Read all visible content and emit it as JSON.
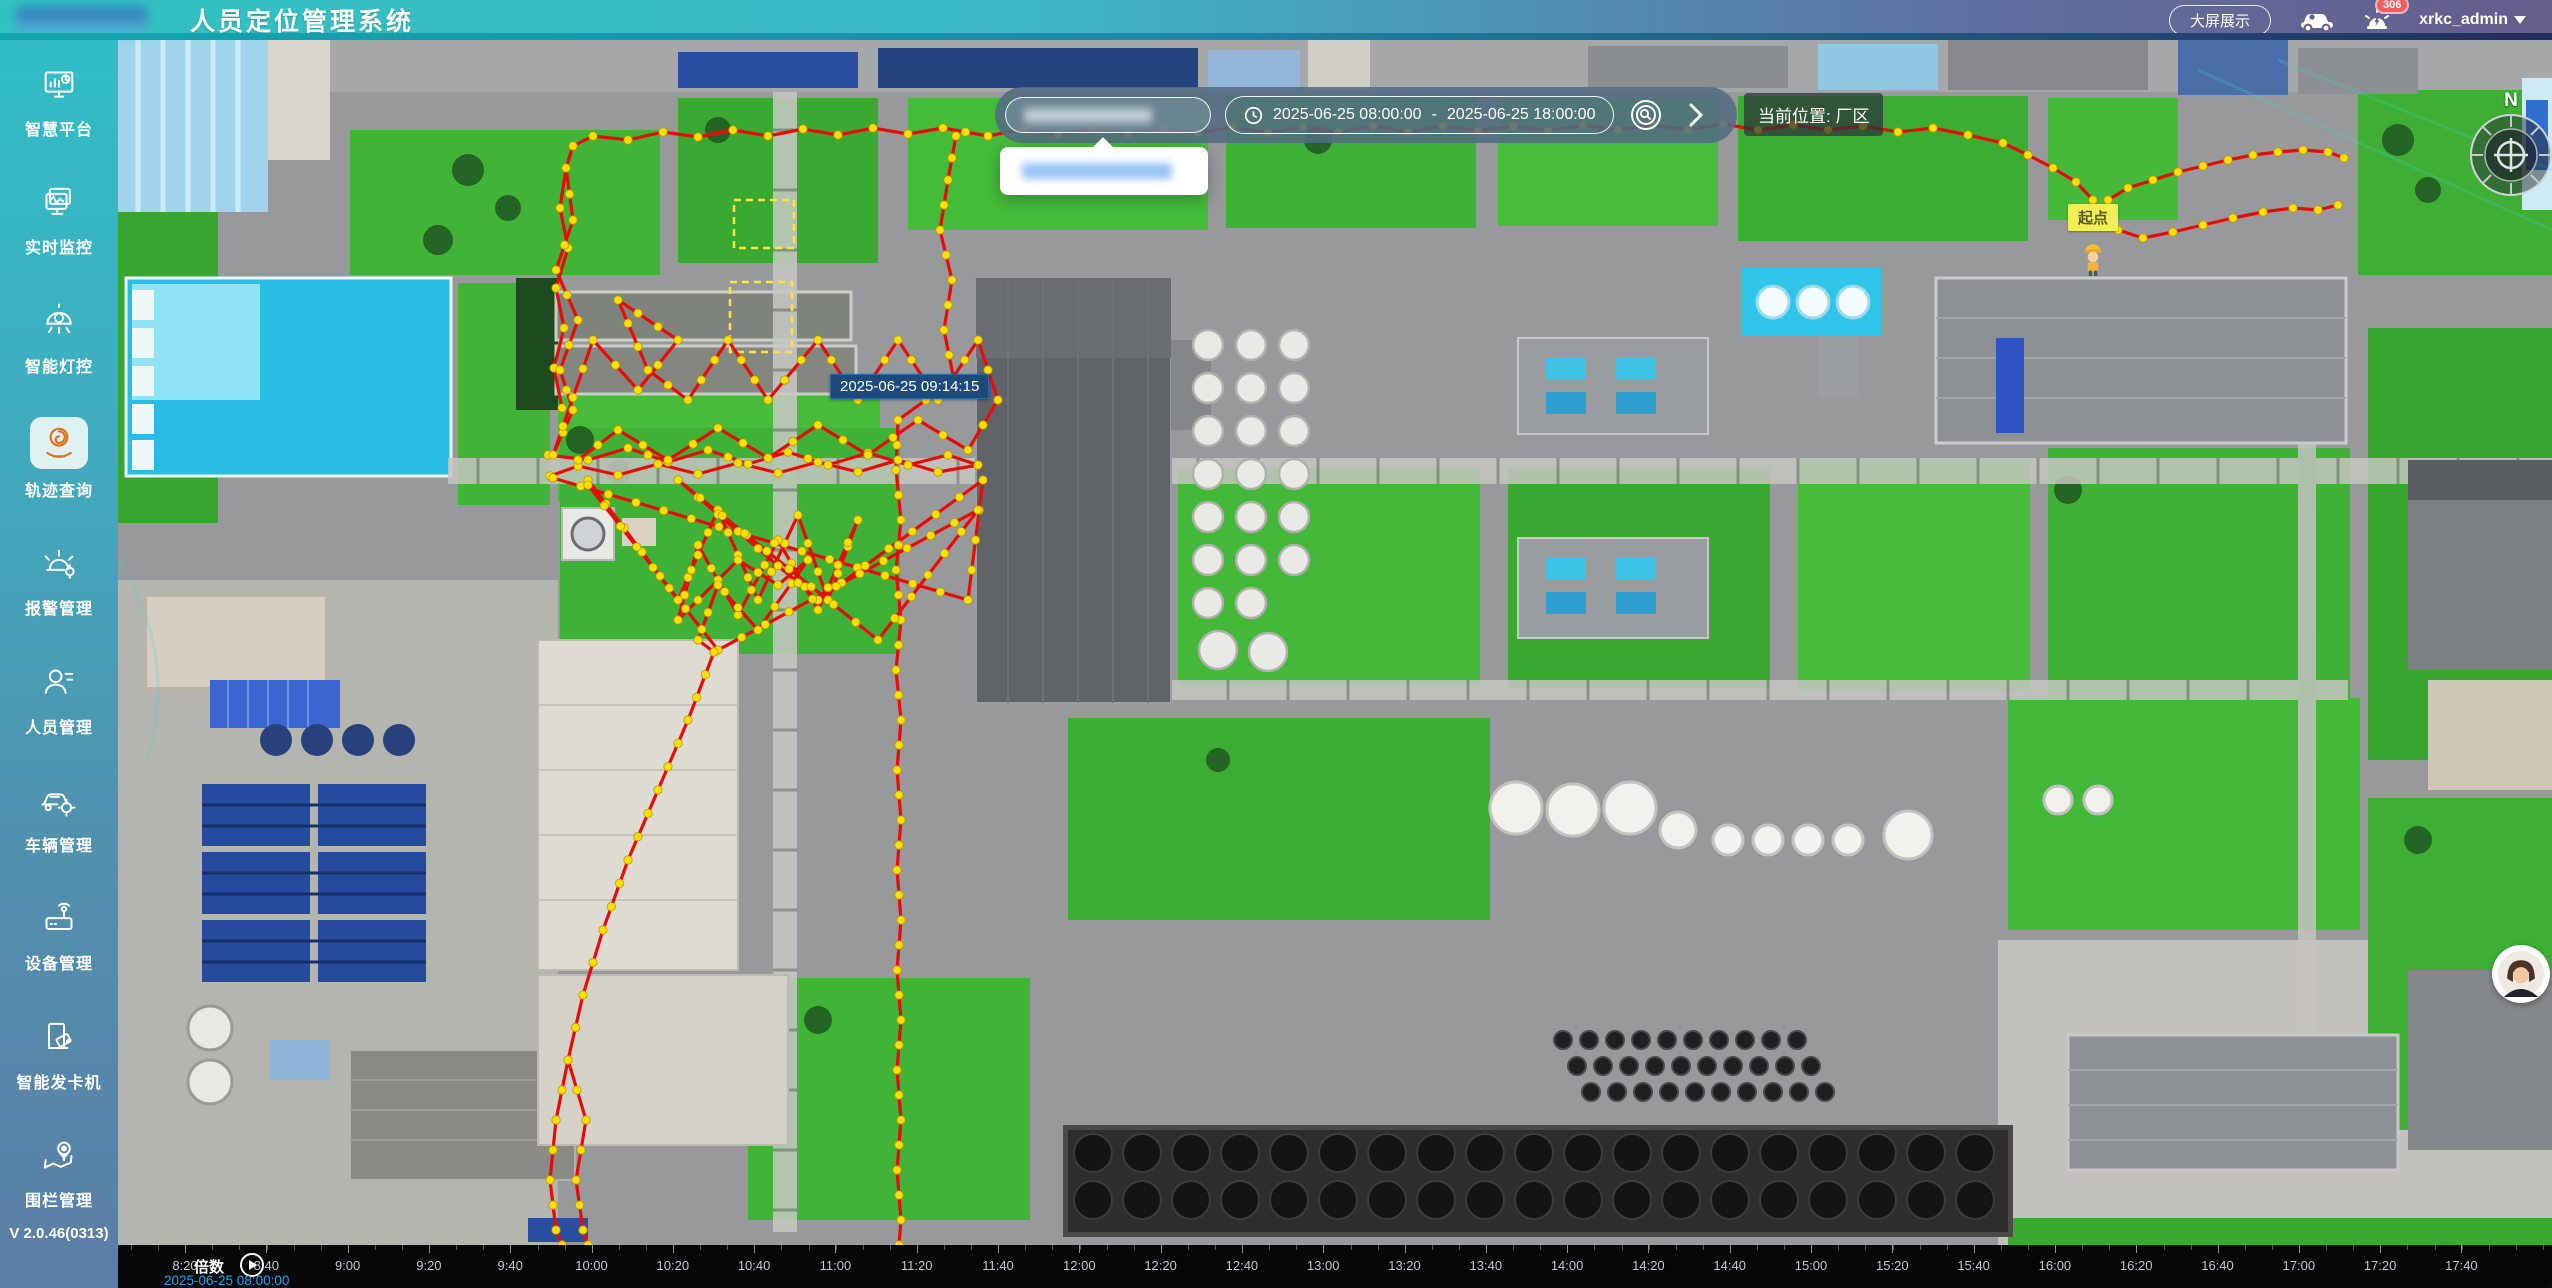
{
  "header": {
    "title": "人员定位管理系统",
    "big_screen_button": "大屏展示",
    "alarm_badge": "306",
    "username": "xrkc_admin"
  },
  "sidebar": {
    "items": [
      {
        "label": "智慧平台",
        "active": false
      },
      {
        "label": "实时监控",
        "active": false
      },
      {
        "label": "智能灯控",
        "active": false
      },
      {
        "label": "轨迹查询",
        "active": true
      },
      {
        "label": "报警管理",
        "active": false
      },
      {
        "label": "人员管理",
        "active": false
      },
      {
        "label": "车辆管理",
        "active": false
      },
      {
        "label": "设备管理",
        "active": false
      },
      {
        "label": "智能发卡机",
        "active": false
      },
      {
        "label": "围栏管理",
        "active": false
      }
    ],
    "version": "V 2.0.46(0313)"
  },
  "toolbar": {
    "date_start": "2025-06-25 08:00:00",
    "date_separator": "-",
    "date_end": "2025-06-25 18:00:00",
    "location_label": "当前位置: 厂区"
  },
  "map": {
    "track_tooltip": "2025-06-25 09:14:15",
    "start_point_label": "起点",
    "compass_label": "N"
  },
  "timeline": {
    "speed_label": "倍数",
    "current_time": "2025-06-25 08:00:00",
    "tick_start_x": 67,
    "tick_step": 81.3,
    "tick_labels": [
      "8:20",
      "8:40",
      "9:00",
      "9:20",
      "9:40",
      "10:00",
      "10:20",
      "10:40",
      "11:00",
      "11:20",
      "11:40",
      "12:00",
      "12:20",
      "12:40",
      "13:00",
      "13:20",
      "13:40",
      "14:00",
      "14:20",
      "14:40",
      "15:00",
      "15:20",
      "15:40",
      "16:00",
      "16:20",
      "16:40",
      "17:00",
      "17:20",
      "17:40"
    ]
  },
  "track": {
    "line_color": "#e60d08",
    "dot_color": "#ffdf00",
    "dot_stroke": "#bb9a00",
    "paths": [
      [
        [
          444,
          368
        ],
        [
          436,
          328
        ],
        [
          446,
          288
        ],
        [
          438,
          248
        ],
        [
          450,
          208
        ],
        [
          442,
          168
        ],
        [
          448,
          128
        ],
        [
          455,
          106
        ],
        [
          475,
          96
        ],
        [
          510,
          100
        ],
        [
          545,
          92
        ],
        [
          580,
          97
        ],
        [
          615,
          90
        ],
        [
          650,
          96
        ],
        [
          685,
          89
        ],
        [
          720,
          95
        ],
        [
          755,
          88
        ],
        [
          790,
          94
        ],
        [
          825,
          88
        ],
        [
          870,
          96
        ],
        [
          905,
          89
        ],
        [
          940,
          95
        ],
        [
          975,
          88
        ],
        [
          1010,
          94
        ],
        [
          1045,
          88
        ],
        [
          1080,
          93
        ],
        [
          1115,
          87
        ],
        [
          1150,
          93
        ],
        [
          1185,
          87
        ],
        [
          1220,
          92
        ],
        [
          1255,
          86
        ],
        [
          1290,
          92
        ],
        [
          1325,
          86
        ],
        [
          1360,
          91
        ],
        [
          1395,
          86
        ],
        [
          1430,
          91
        ],
        [
          1465,
          85
        ],
        [
          1500,
          90
        ],
        [
          1535,
          85
        ],
        [
          1570,
          90
        ],
        [
          1605,
          84
        ],
        [
          1640,
          90
        ],
        [
          1675,
          85
        ],
        [
          1710,
          90
        ],
        [
          1745,
          86
        ],
        [
          1780,
          92
        ],
        [
          1815,
          88
        ],
        [
          1850,
          95
        ],
        [
          1885,
          103
        ],
        [
          1910,
          115
        ],
        [
          1935,
          128
        ],
        [
          1958,
          142
        ],
        [
          1975,
          160
        ],
        [
          1982,
          178
        ],
        [
          1990,
          160
        ],
        [
          2010,
          148
        ],
        [
          2035,
          140
        ],
        [
          2060,
          132
        ],
        [
          2085,
          126
        ],
        [
          2110,
          120
        ],
        [
          2135,
          115
        ],
        [
          2160,
          112
        ],
        [
          2185,
          110
        ],
        [
          2210,
          112
        ],
        [
          2226,
          118
        ]
      ],
      [
        [
          1982,
          178
        ],
        [
          2000,
          190
        ],
        [
          2025,
          198
        ],
        [
          2055,
          192
        ],
        [
          2085,
          185
        ],
        [
          2115,
          178
        ],
        [
          2145,
          172
        ],
        [
          2175,
          168
        ],
        [
          2200,
          170
        ],
        [
          2220,
          165
        ]
      ],
      [
        [
          838,
          96
        ],
        [
          830,
          140
        ],
        [
          822,
          190
        ],
        [
          834,
          240
        ],
        [
          826,
          290
        ],
        [
          836,
          340
        ],
        [
          780,
          380
        ],
        [
          778,
          430
        ],
        [
          783,
          480
        ],
        [
          778,
          530
        ],
        [
          783,
          580
        ],
        [
          778,
          630
        ],
        [
          783,
          680
        ],
        [
          779,
          730
        ],
        [
          783,
          780
        ],
        [
          779,
          830
        ],
        [
          783,
          880
        ],
        [
          779,
          930
        ],
        [
          783,
          980
        ],
        [
          779,
          1030
        ],
        [
          783,
          1080
        ],
        [
          779,
          1130
        ],
        [
          783,
          1180
        ],
        [
          781,
          1205
        ]
      ],
      [
        [
          430,
          415
        ],
        [
          470,
          420
        ],
        [
          510,
          408
        ],
        [
          550,
          422
        ],
        [
          590,
          410
        ],
        [
          630,
          424
        ],
        [
          670,
          412
        ],
        [
          710,
          425
        ],
        [
          750,
          413
        ],
        [
          790,
          425
        ],
        [
          830,
          415
        ],
        [
          860,
          425
        ],
        [
          820,
          432
        ],
        [
          780,
          420
        ],
        [
          740,
          432
        ],
        [
          700,
          422
        ],
        [
          660,
          433
        ],
        [
          620,
          423
        ],
        [
          580,
          434
        ],
        [
          540,
          424
        ],
        [
          500,
          435
        ],
        [
          460,
          426
        ],
        [
          432,
          436
        ]
      ],
      [
        [
          448,
          128
        ],
        [
          455,
          180
        ],
        [
          438,
          230
        ],
        [
          460,
          280
        ],
        [
          442,
          330
        ],
        [
          455,
          370
        ],
        [
          435,
          415
        ],
        [
          475,
          300
        ],
        [
          520,
          350
        ],
        [
          560,
          300
        ],
        [
          500,
          260
        ],
        [
          530,
          330
        ],
        [
          570,
          360
        ],
        [
          610,
          300
        ],
        [
          650,
          360
        ],
        [
          700,
          300
        ],
        [
          740,
          360
        ],
        [
          780,
          300
        ],
        [
          820,
          360
        ],
        [
          860,
          300
        ],
        [
          880,
          360
        ],
        [
          850,
          410
        ],
        [
          800,
          380
        ],
        [
          750,
          415
        ],
        [
          700,
          385
        ],
        [
          650,
          418
        ],
        [
          600,
          388
        ],
        [
          550,
          420
        ],
        [
          500,
          390
        ],
        [
          460,
          420
        ]
      ],
      [
        [
          470,
          440
        ],
        [
          560,
          560
        ],
        [
          600,
          470
        ],
        [
          640,
          560
        ],
        [
          680,
          475
        ],
        [
          710,
          560
        ],
        [
          740,
          480
        ],
        [
          700,
          570
        ],
        [
          660,
          500
        ],
        [
          620,
          575
        ],
        [
          580,
          505
        ],
        [
          560,
          580
        ],
        [
          620,
          520
        ],
        [
          660,
          545
        ],
        [
          690,
          520
        ],
        [
          640,
          590
        ],
        [
          600,
          545
        ],
        [
          580,
          600
        ],
        [
          596,
          612
        ]
      ],
      [
        [
          435,
          438
        ],
        [
          850,
          560
        ],
        [
          865,
          440
        ],
        [
          700,
          560
        ],
        [
          560,
          440
        ],
        [
          760,
          600
        ],
        [
          860,
          470
        ],
        [
          600,
          610
        ],
        [
          470,
          445
        ]
      ],
      [
        [
          596,
          612
        ],
        [
          570,
          680
        ],
        [
          540,
          750
        ],
        [
          510,
          820
        ],
        [
          485,
          890
        ],
        [
          465,
          955
        ],
        [
          450,
          1020
        ],
        [
          438,
          1080
        ],
        [
          432,
          1140
        ],
        [
          438,
          1190
        ],
        [
          444,
          1205
        ]
      ],
      [
        [
          450,
          1020
        ],
        [
          468,
          1080
        ],
        [
          458,
          1140
        ],
        [
          465,
          1190
        ],
        [
          470,
          1205
        ]
      ]
    ]
  }
}
